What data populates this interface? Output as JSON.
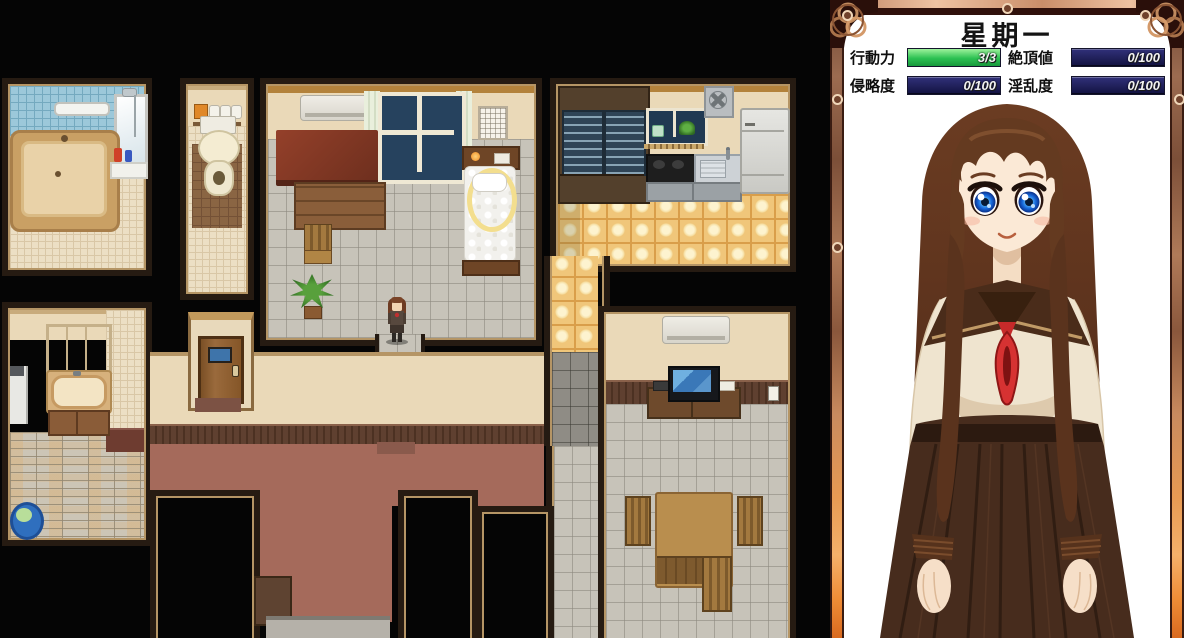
{
  "hud": {
    "title": "星期一",
    "stats": [
      {
        "label": "行動力",
        "value": "3/3",
        "fill": 1,
        "color": "green"
      },
      {
        "label": "絶頂値",
        "value": "0/100",
        "fill": 0,
        "color": "navy"
      },
      {
        "label": "侵略度",
        "value": "0/100",
        "fill": 0,
        "color": "navy"
      },
      {
        "label": "淫乱度",
        "value": "0/100",
        "fill": 0,
        "color": "navy"
      }
    ],
    "colors": {
      "action_bar_green": "#2cc152",
      "stat_bar_navy": "#1c1c52",
      "frame_copper": "#b97f5c",
      "frame_orange": "#ee8a33",
      "panel_bg": "#ffffff"
    }
  },
  "map": {
    "rooms": [
      "bathroom",
      "toilet",
      "bedroom",
      "kitchen",
      "washroom",
      "hallway",
      "dining-room"
    ],
    "player": {
      "location": "bedroom-doorway"
    },
    "colors": {
      "hall_floor": "#a56a5b",
      "kitchen_floor": "#f0c67a",
      "gray_tile_floor": "#c7c3b9",
      "bath_wall_tile": "#9cc8da",
      "void": "#050505"
    }
  }
}
